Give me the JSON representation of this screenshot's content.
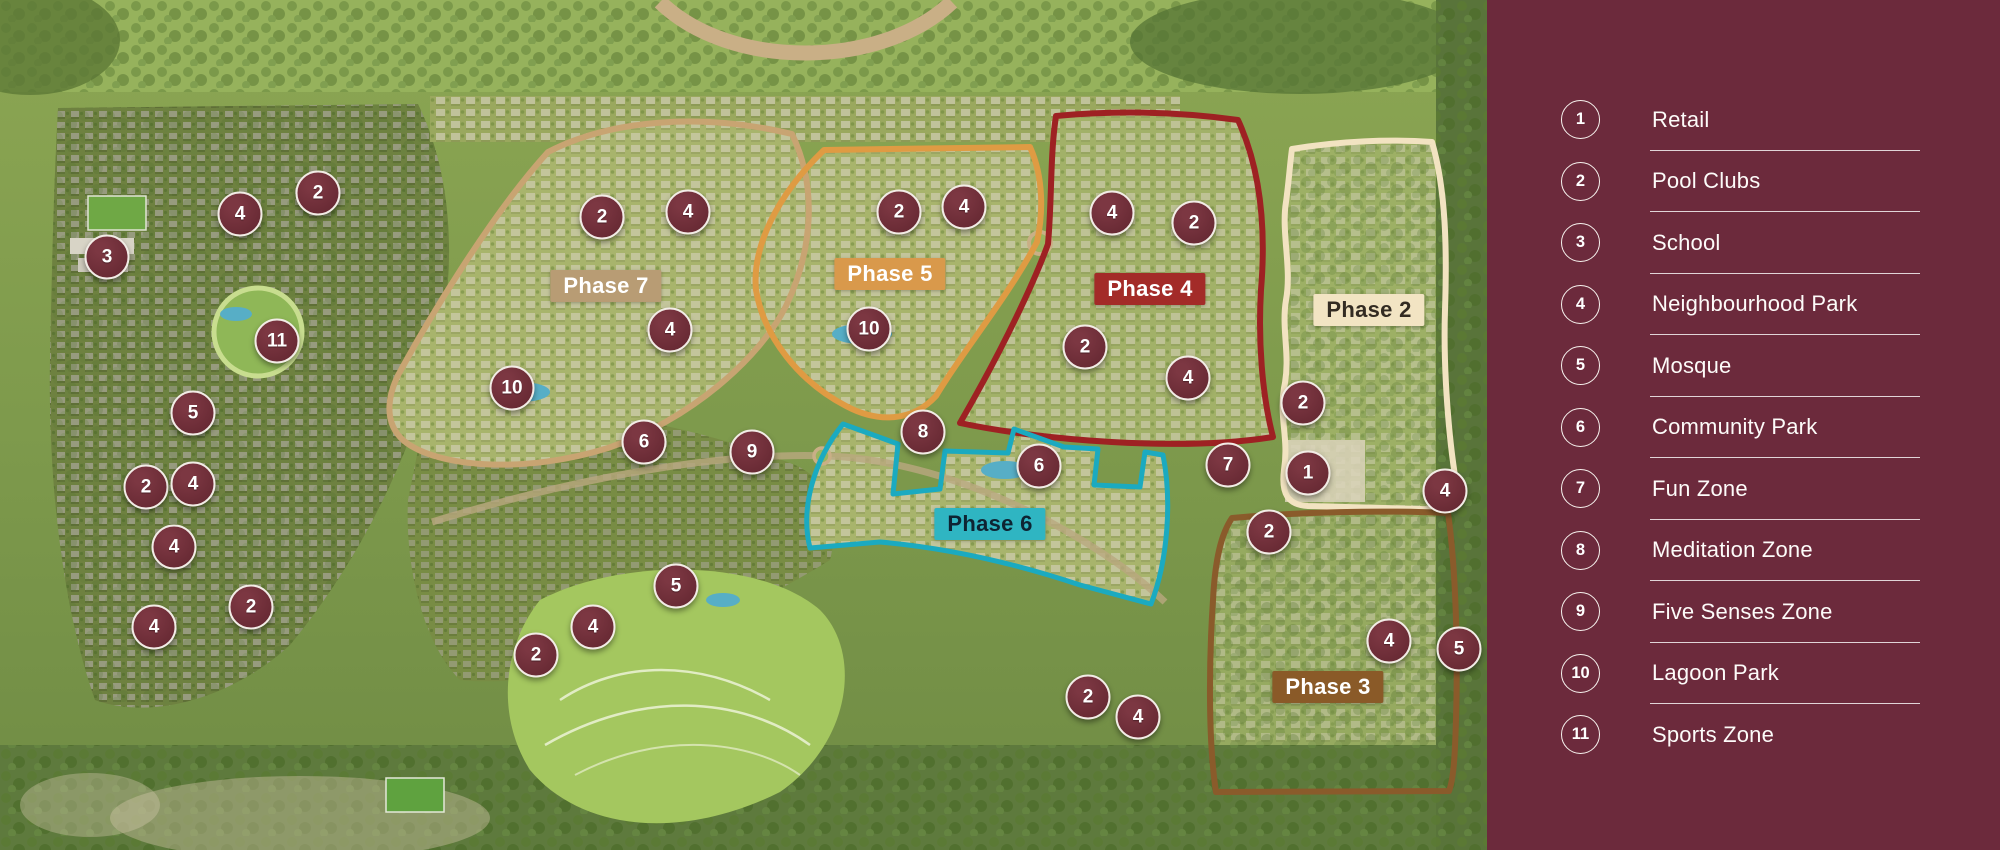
{
  "legend": {
    "items": [
      {
        "num": "1",
        "label": "Retail"
      },
      {
        "num": "2",
        "label": "Pool Clubs"
      },
      {
        "num": "3",
        "label": "School"
      },
      {
        "num": "4",
        "label": "Neighbourhood Park"
      },
      {
        "num": "5",
        "label": "Mosque"
      },
      {
        "num": "6",
        "label": "Community Park"
      },
      {
        "num": "7",
        "label": "Fun Zone"
      },
      {
        "num": "8",
        "label": "Meditation Zone"
      },
      {
        "num": "9",
        "label": "Five Senses Zone"
      },
      {
        "num": "10",
        "label": "Lagoon Park"
      },
      {
        "num": "11",
        "label": "Sports Zone"
      }
    ]
  },
  "map": {
    "phases": [
      {
        "label": "Phase 7",
        "x": 606,
        "y": 286,
        "label_bg": "#B89C74",
        "label_fg": "#FFFFFF",
        "outline_color": "#C8A472"
      },
      {
        "label": "Phase 5",
        "x": 890,
        "y": 274,
        "label_bg": "#D9994B",
        "label_fg": "#FFFFFF",
        "outline_color": "#DF9B43"
      },
      {
        "label": "Phase 4",
        "x": 1150,
        "y": 289,
        "label_bg": "#A32B28",
        "label_fg": "#FFFFFF",
        "outline_color": "#9E2123"
      },
      {
        "label": "Phase 2",
        "x": 1369,
        "y": 310,
        "label_bg": "#F2E4C3",
        "label_fg": "#332B22",
        "outline_color": "#F2E3C1"
      },
      {
        "label": "Phase 6",
        "x": 990,
        "y": 524,
        "label_bg": "#2FB5C2",
        "label_fg": "#0E2433",
        "outline_color": "#1BAAC0"
      },
      {
        "label": "Phase 3",
        "x": 1328,
        "y": 687,
        "label_bg": "#8A5A28",
        "label_fg": "#FFFFFF",
        "outline_color": "#8A5B2B"
      }
    ],
    "markers": [
      {
        "n": "4",
        "x": 240,
        "y": 214
      },
      {
        "n": "2",
        "x": 318,
        "y": 193
      },
      {
        "n": "3",
        "x": 107,
        "y": 257
      },
      {
        "n": "11",
        "x": 277,
        "y": 341
      },
      {
        "n": "5",
        "x": 193,
        "y": 413
      },
      {
        "n": "2",
        "x": 146,
        "y": 487
      },
      {
        "n": "4",
        "x": 193,
        "y": 484
      },
      {
        "n": "4",
        "x": 174,
        "y": 547
      },
      {
        "n": "4",
        "x": 154,
        "y": 627
      },
      {
        "n": "2",
        "x": 251,
        "y": 607
      },
      {
        "n": "2",
        "x": 602,
        "y": 217
      },
      {
        "n": "4",
        "x": 688,
        "y": 212
      },
      {
        "n": "4",
        "x": 670,
        "y": 330
      },
      {
        "n": "10",
        "x": 512,
        "y": 388
      },
      {
        "n": "2",
        "x": 899,
        "y": 212
      },
      {
        "n": "4",
        "x": 964,
        "y": 207
      },
      {
        "n": "10",
        "x": 869,
        "y": 329
      },
      {
        "n": "4",
        "x": 1112,
        "y": 213
      },
      {
        "n": "2",
        "x": 1194,
        "y": 223
      },
      {
        "n": "2",
        "x": 1085,
        "y": 347
      },
      {
        "n": "4",
        "x": 1188,
        "y": 378
      },
      {
        "n": "2",
        "x": 1303,
        "y": 403
      },
      {
        "n": "1",
        "x": 1308,
        "y": 473
      },
      {
        "n": "4",
        "x": 1445,
        "y": 491
      },
      {
        "n": "8",
        "x": 923,
        "y": 432
      },
      {
        "n": "6",
        "x": 1039,
        "y": 466
      },
      {
        "n": "7",
        "x": 1228,
        "y": 465
      },
      {
        "n": "2",
        "x": 1269,
        "y": 532
      },
      {
        "n": "6",
        "x": 644,
        "y": 442
      },
      {
        "n": "9",
        "x": 752,
        "y": 452
      },
      {
        "n": "5",
        "x": 676,
        "y": 586
      },
      {
        "n": "4",
        "x": 593,
        "y": 627
      },
      {
        "n": "2",
        "x": 536,
        "y": 655
      },
      {
        "n": "2",
        "x": 1088,
        "y": 697
      },
      {
        "n": "4",
        "x": 1138,
        "y": 717
      },
      {
        "n": "4",
        "x": 1389,
        "y": 641
      },
      {
        "n": "5",
        "x": 1459,
        "y": 649
      }
    ]
  },
  "colors": {
    "sidebar_bg": "#6C2A3C",
    "marker_fill": "#682A34",
    "marker_border": "#F2ECE6"
  }
}
